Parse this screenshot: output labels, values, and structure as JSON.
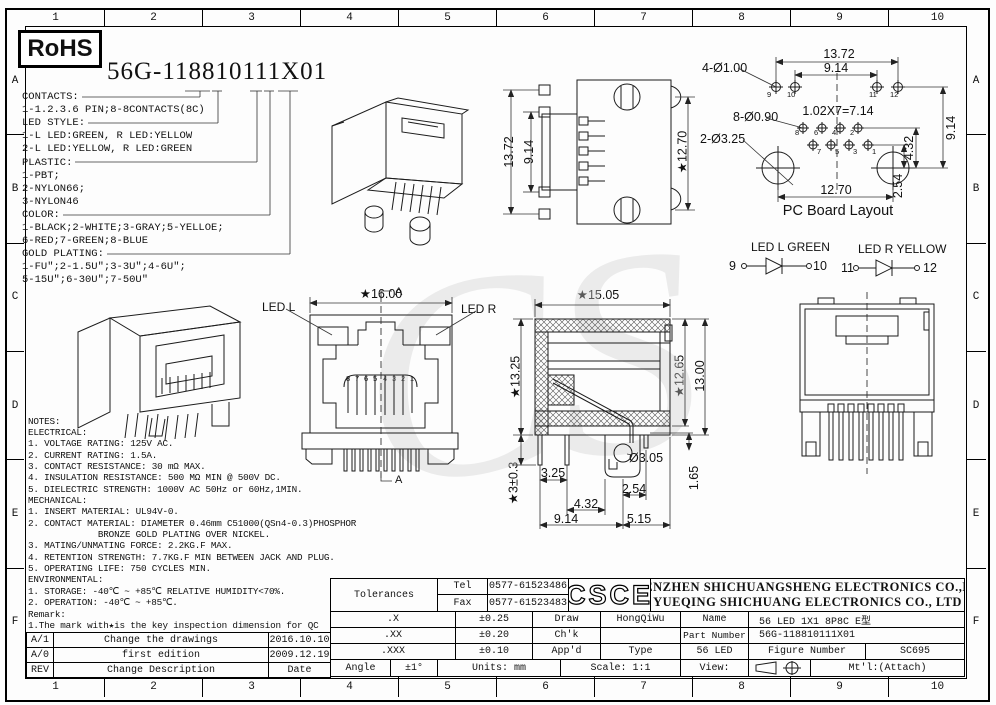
{
  "frame": {
    "cols": [
      "1",
      "2",
      "3",
      "4",
      "5",
      "6",
      "7",
      "8",
      "9",
      "10"
    ],
    "rows": [
      "A",
      "B",
      "C",
      "D",
      "E",
      "F"
    ]
  },
  "watermark": "CS",
  "rohs": "RoHS",
  "part_heading": "56G-118810111X01",
  "ordering": {
    "lines": [
      "CONTACTS:",
      "1-1.2.3.6 PIN;8-8CONTACTS(8C)",
      "LED STYLE:",
      "1-L LED:GREEN, R LED:YELLOW",
      "2-L LED:YELLOW, R LED:GREEN",
      "PLASTIC:",
      "1-PBT;",
      "2-NYLON66;",
      "3-NYLON46",
      "COLOR:",
      "1-BLACK;2-WHITE;3-GRAY;5-YELLOE;",
      "6-RED;7-GREEN;8-BLUE",
      "GOLD PLATING:",
      "1-FU″;2-1.5U″;3-3U″;4-6U″;",
      "5-15U″;6-30U″;7-50U″"
    ]
  },
  "views": {
    "front": {
      "dim_width": "★16.00",
      "led_l": "LED L",
      "led_r": "LED R",
      "section_top": "A",
      "section_bottom": "A",
      "pins": [
        "8",
        "7",
        "6",
        "5",
        "4",
        "3",
        "2",
        "1"
      ]
    },
    "rear": {
      "dim_outer": "13.72",
      "dim_inner": "9.14",
      "dim_width": "★12.70"
    },
    "pcb": {
      "title": "PC Board Layout",
      "dim_top": "13.72",
      "dim_top2": "9.14",
      "label_holes_small": "4-Ø1.00",
      "label_holes_pin": "8-Ø0.90",
      "label_holes_big": "2-Ø3.25",
      "pitch": "1.02X7=7.14",
      "dim_right": "9.14",
      "dim_right2": "4.32",
      "dim_right3": "2.54",
      "dim_bottom": "12.70",
      "pins_top": [
        "9",
        "10",
        "11",
        "12"
      ],
      "pins_upper": [
        "8",
        "6",
        "4",
        "2"
      ],
      "pins_lower": [
        "7",
        "5",
        "3",
        "1"
      ]
    },
    "legend": {
      "l_title": "LED L GREEN",
      "l_a": "9",
      "l_b": "10",
      "r_title": "LED R YELLOW",
      "r_a": "11",
      "r_b": "12"
    },
    "section": {
      "dim_top": "★15.05",
      "dim_left": "★13.25",
      "dim_left2": "★3±0.3",
      "dim_right": "★12.65",
      "dim_right2": "13.00",
      "d1": "3.25",
      "d2": "Ø3.05",
      "d3": "2.54",
      "d4": "1.65",
      "d5": "4.32",
      "d6": "9.14",
      "d7": "5.15"
    }
  },
  "notes": {
    "lines": [
      "NOTES:",
      "ELECTRICAL:",
      "1. VOLTAGE RATING: 125V AC.",
      "2. CURRENT RATING: 1.5A.",
      "3. CONTACT RESISTANCE: 30 mΩ MAX.",
      "4. INSULATION RESISTANCE: 500 MΩ MIN @ 500V DC.",
      "5. DIELECTRIC STRENGTH: 1000V AC 50Hz or 60Hz,1MIN.",
      "MECHANICAL:",
      "1. INSERT MATERIAL: UL94V-0.",
      "2. CONTACT MATERIAL: DIAMETER 0.46mm C51000(QSn4-0.3)PHOSPHOR",
      "             BRONZE GOLD PLATING OVER NICKEL.",
      "3. MATING/UNMATING FORCE: 2.2KG.F MAX.",
      "4. RETENTION STRENGTH: 7.7KG.F MIN BETWEEN JACK AND PLUG.",
      "5. OPERATING LIFE: 750 CYCLES MIN.",
      "ENVIRONMENTAL:",
      "1. STORAGE: -40℃ ~ +85℃ RELATIVE HUMIDITY<70%.",
      "2. OPERATION: -40℃ ~ +85℃.",
      "Remark:",
      "1.The mark with★is the key inspection dimension for QC"
    ]
  },
  "revisions": {
    "rows": [
      {
        "rev": "A/1",
        "desc": "Change the drawings",
        "date": "2016.10.10"
      },
      {
        "rev": "A/0",
        "desc": "first edition",
        "date": "2009.12.19"
      },
      {
        "rev": "REV",
        "desc": "Change Description",
        "date": "Date"
      }
    ]
  },
  "titleblock": {
    "tolerances_label": "Tolerances",
    "tel_label": "Tel",
    "tel": "0577-61523486",
    "fax_label": "Fax",
    "fax": "0577-61523483",
    "logo": "CSCE",
    "company_line1": "SHENZHEN SHICHUANGSHENG ELECTRONICS CO.,LTD",
    "company_line2": "YUEQING SHICHUANG ELECTRONICS CO., LTD",
    "tol_rows": [
      {
        "label": ".X",
        "value": "±0.25"
      },
      {
        "label": ".XX",
        "value": "±0.20"
      },
      {
        "label": ".XXX",
        "value": "±0.10"
      }
    ],
    "angle_label": "Angle",
    "angle_value": "±1°",
    "draw_label": "Draw",
    "draw_value": "HongQiWu",
    "chk_label": "Ch'k",
    "appd_label": "App'd",
    "units": "Units: mm",
    "scale": "Scale: 1:1",
    "name_label": "Name",
    "name_value": "56 LED 1X1 8P8C E型",
    "part_label": "Part Number",
    "part_value": "56G-118810111X01",
    "type_label": "Type",
    "type_value": "56 LED",
    "figure_label": "Figure Number",
    "figure_value": "SC695",
    "view_label": "View:",
    "mtl_label": "Mt'l:(Attach)"
  }
}
